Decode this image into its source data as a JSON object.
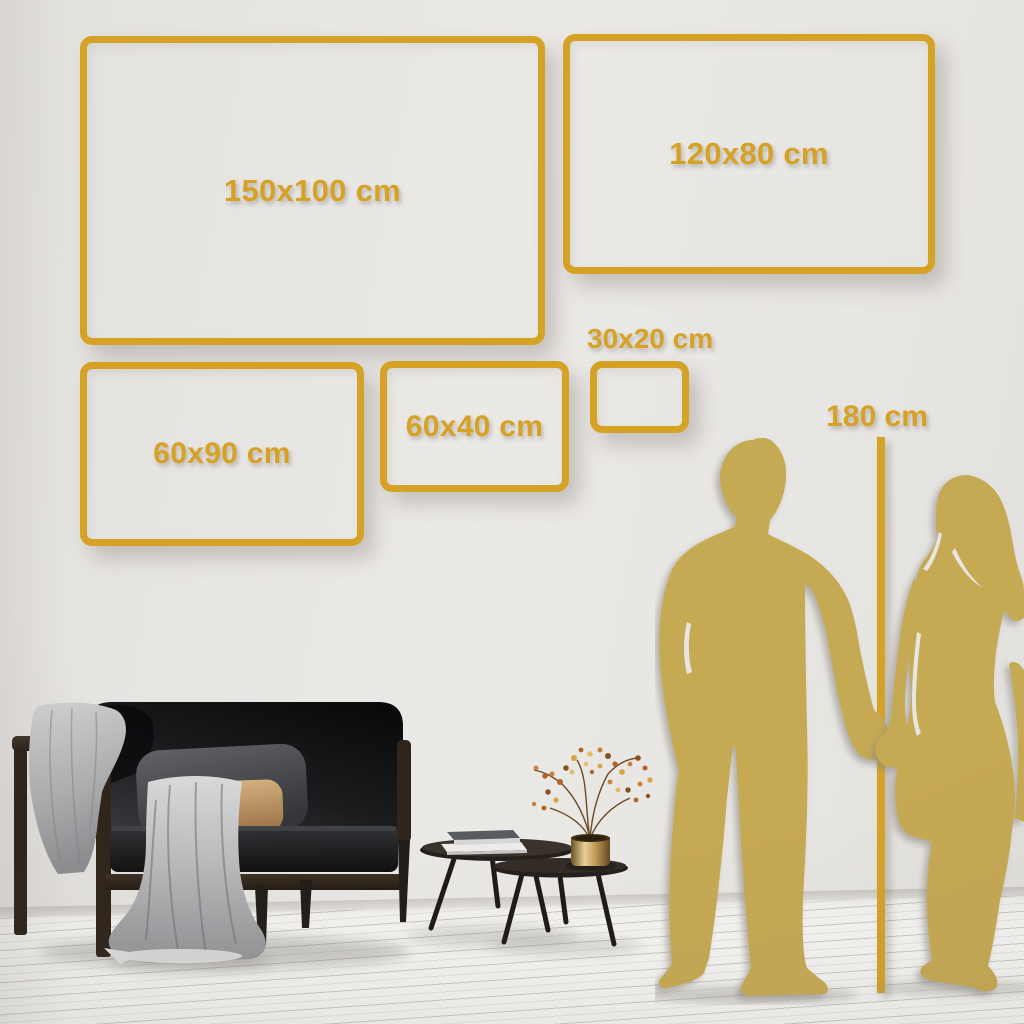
{
  "colors": {
    "accent_gold": "#D6A226",
    "silhouette_gold": "#C6A952",
    "wall": "#E9E7E4",
    "floor": "#F3F2F0"
  },
  "unit": "cm",
  "frames": [
    {
      "label": "150x100 cm",
      "width_cm": 150,
      "height_cm": 100
    },
    {
      "label": "120x80 cm",
      "width_cm": 120,
      "height_cm": 80
    },
    {
      "label": "60x90 cm",
      "width_cm": 60,
      "height_cm": 90
    },
    {
      "label": "60x40 cm",
      "width_cm": 60,
      "height_cm": 40
    },
    {
      "label": "30x20 cm",
      "width_cm": 30,
      "height_cm": 20
    }
  ],
  "height_marker": {
    "label": "180 cm",
    "height_cm": 180
  },
  "scene": {
    "objects": [
      "man-silhouette",
      "woman-silhouette",
      "sofa",
      "gray-blanket",
      "back-cushion",
      "tan-pillow",
      "nesting-coffee-tables",
      "book-stack",
      "brass-vase",
      "dried-flower-branch"
    ]
  }
}
